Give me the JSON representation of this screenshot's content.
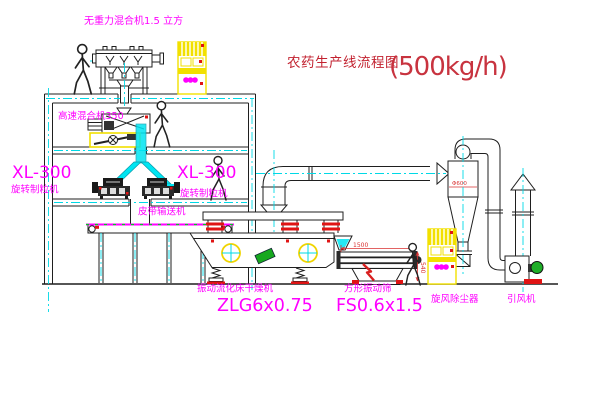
{
  "title": {
    "name": "农药生产线流程图",
    "capacity": "(500kg/h)"
  },
  "equipment_labels": {
    "no_gravity_mixer": "无重力混合机1.5 立方",
    "high_speed_mixer": "高速混合机350",
    "granulator_left_model": "XL-300",
    "granulator_left_name": "旋转制粒机",
    "granulator_right_model": "XL-300",
    "granulator_right_name": "旋转制粒机",
    "belt_conveyor": "皮带输送机",
    "dryer_name": "振动流化床干燥机",
    "dryer_model": "ZLG6x0.75",
    "screen_name": "方形振动筛",
    "screen_model": "FS0.6x1.5",
    "cyclone": "旋风除尘器",
    "fan": "引风机"
  },
  "dimensions": {
    "screen_length": "1500",
    "screen_height": "540",
    "cyclone_diameter": "Φ600"
  },
  "colors": {
    "label_magenta": "#ff00ff",
    "annotation_red": "#d93030",
    "centerline_cyan": "#00d9e6",
    "cabinet_yellow": "#f2e000",
    "motor_green": "#1fae28",
    "line_black": "#1f1f1f",
    "background": "#ffffff"
  }
}
